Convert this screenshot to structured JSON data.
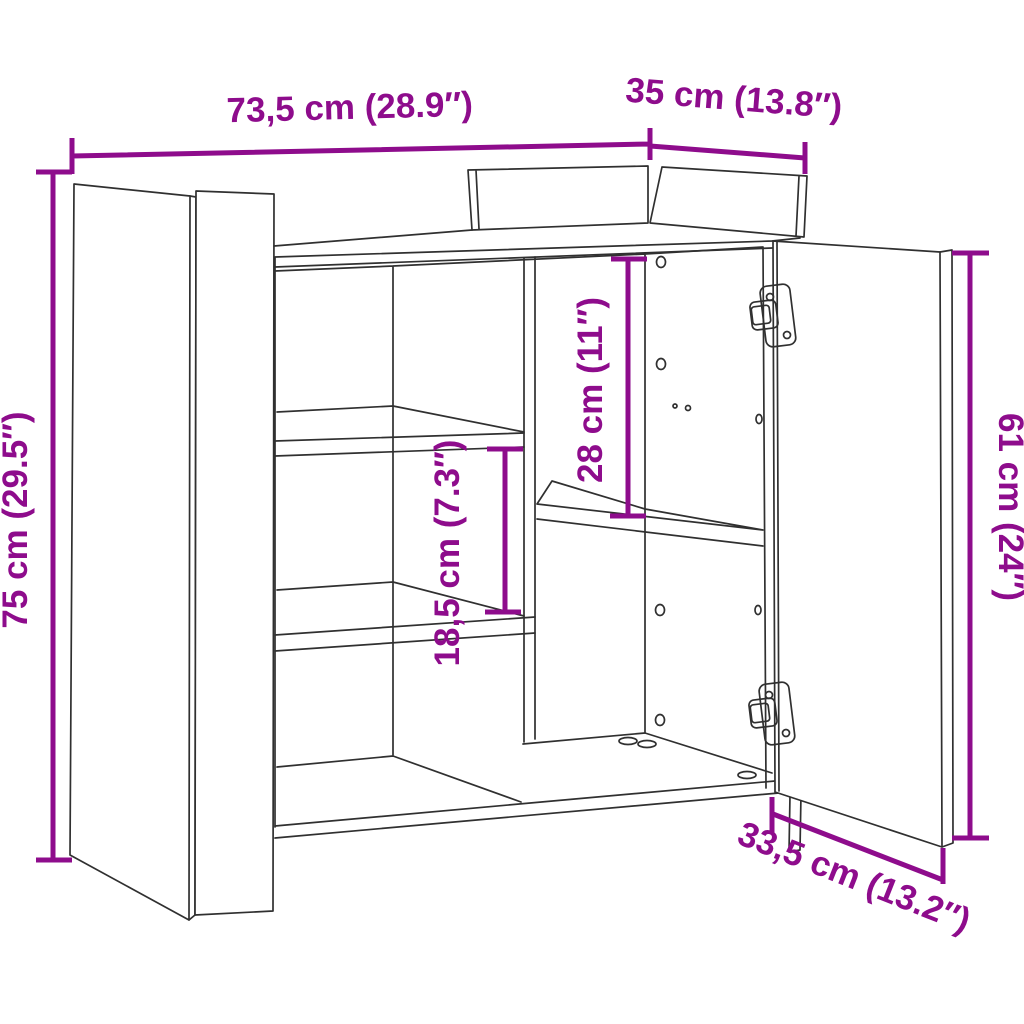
{
  "diagram": {
    "type": "furniture-dimension-drawing",
    "subject": "sideboard with open doors, interior shelves and cup hinges",
    "background_color": "#FFFFFF",
    "line_color": "#303030",
    "accent_color": "#8E0C8C",
    "dimensions": {
      "width": {
        "label": "73,5 cm (28.9″)",
        "cm": "73,5",
        "inches": "28.9"
      },
      "depth": {
        "label": "35 cm (13.8″)",
        "cm": "35",
        "inches": "13.8"
      },
      "height": {
        "label": "75 cm (29.5″)",
        "cm": "75",
        "inches": "29.5"
      },
      "door_height": {
        "label": "61 cm (24″)",
        "cm": "61",
        "inches": "24"
      },
      "shelf_spacing": {
        "label": "18,5 cm (7.3″)",
        "cm": "18,5",
        "inches": "7.3"
      },
      "upper_compartment": {
        "label": "28 cm (11″)",
        "cm": "28",
        "inches": "11"
      },
      "door_width": {
        "label": "33,5 cm (13.2″)",
        "cm": "33,5",
        "inches": "13.2"
      }
    }
  }
}
